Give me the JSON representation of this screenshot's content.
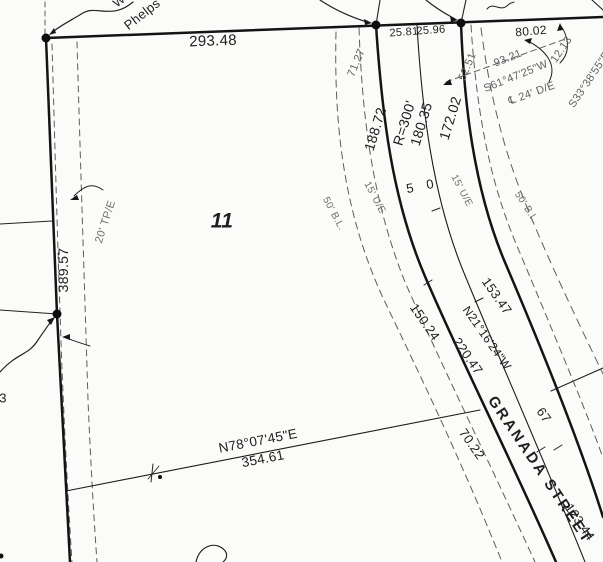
{
  "labels": {
    "north_len": "293.48",
    "owner": "Phelps",
    "owner_partial": "W",
    "seg1": "25.81",
    "seg2": "25.96",
    "seg3": "80.02",
    "dim_7127": "71.27",
    "dim_5251": "52.51",
    "dim_9321": "93.21",
    "bearing_s61": "S61°47'25\"W",
    "easement_de": "℄ 24' D/E",
    "dim_1213": "12.13",
    "bearing_s33": "S33°38'55\"E",
    "arc_west": "188.72",
    "radius": "R=300'",
    "arc_center": "180.35",
    "arc_east": "172.02",
    "width_left": "5",
    "width_right": "0",
    "ue_left": "15' U/E",
    "ue_right": "15' U/E",
    "bl_left": "50' B.L.",
    "bl_right": "50' B.L.",
    "lot": "11",
    "tpe": "20' TP/E",
    "west_len": "389.57",
    "front_west": "150.24",
    "front_east": "153.47",
    "cl_bearing": "N21°16'24\"W",
    "cl_dist": "220.47",
    "street": "GRANADA STREET",
    "lower_west": "70.22",
    "lot_east": "67",
    "lower_east": "123.44",
    "south_bearing": "N78°07'45\"E",
    "south_len": "354.61",
    "partial_3": "3"
  }
}
